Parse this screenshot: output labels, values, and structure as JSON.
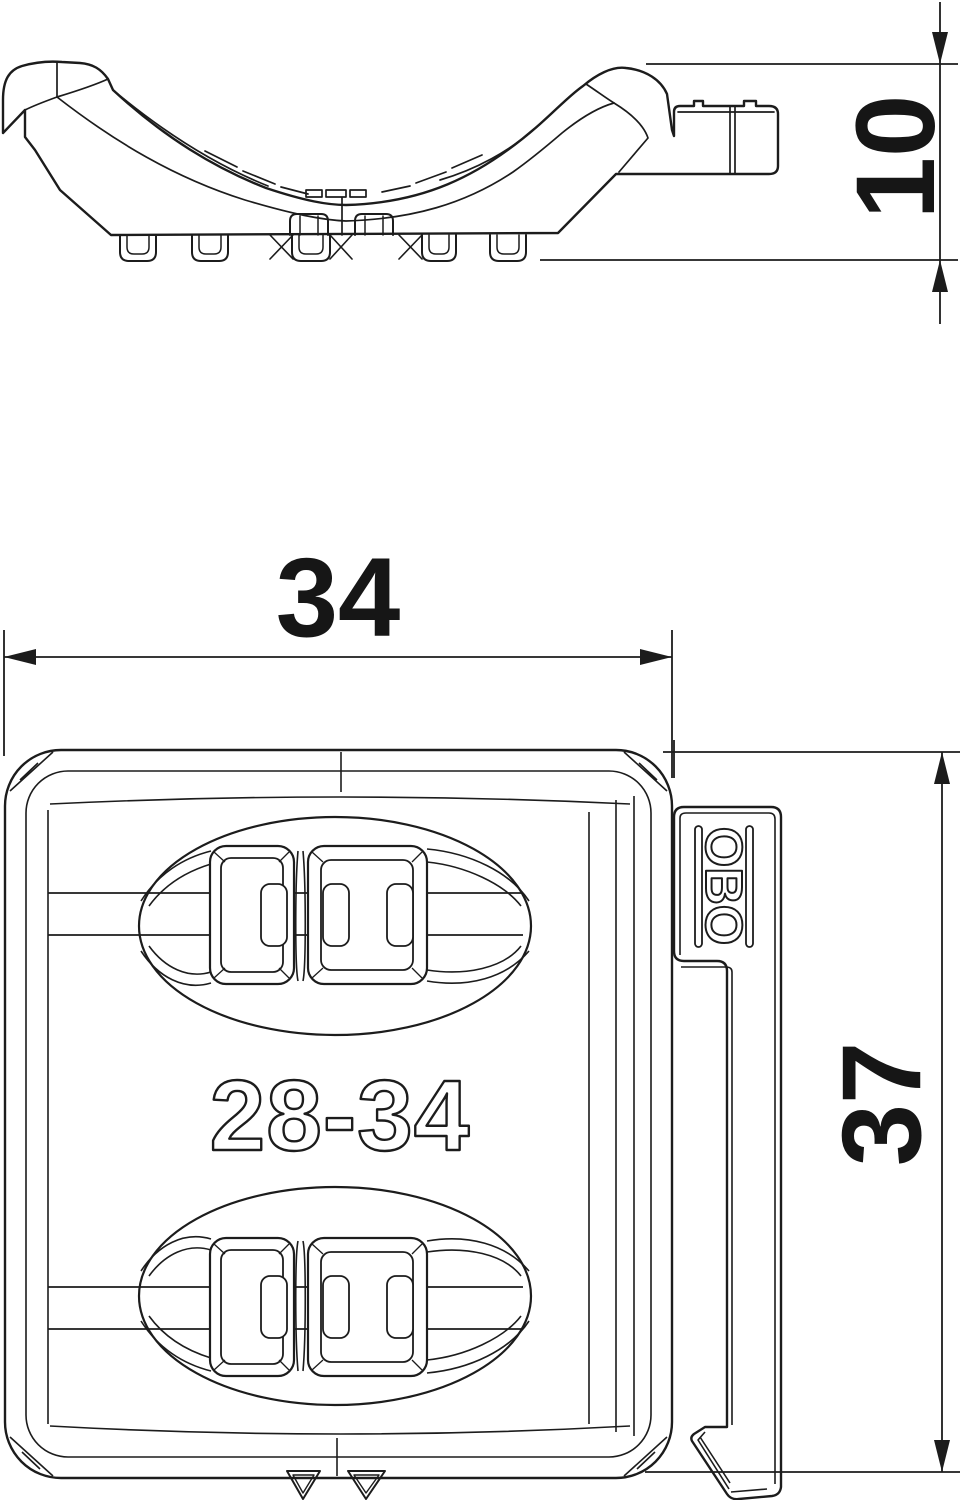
{
  "page": {
    "background_color": "#ffffff",
    "line_color": "#1c1c1c"
  },
  "side_view": {
    "description": "side profile of pipe clamp saddle",
    "height_dimension": {
      "label": "10"
    }
  },
  "plan_view": {
    "description": "top view of pipe clamp body with latch",
    "width_dimension": {
      "label": "34"
    },
    "height_dimension": {
      "label": "37"
    },
    "embossed_range_label": "28-34",
    "brand_logo_text": "OBO"
  }
}
